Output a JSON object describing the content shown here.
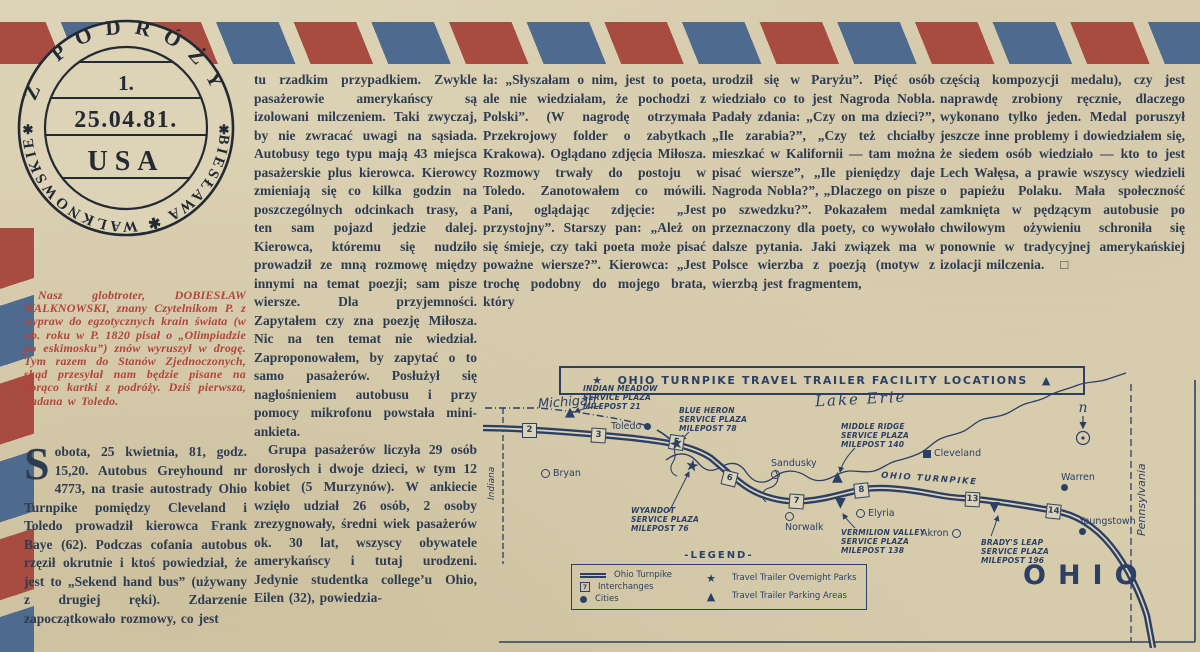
{
  "page": {
    "paper_color": "#dcd2b4",
    "ink_color": "#2e3c52",
    "accent_red": "#b2453b",
    "stripe_red": "#a84b41",
    "stripe_blue": "#4e6a8e",
    "map_ink": "#2c4066"
  },
  "stamp": {
    "arc_top": "Z PODRÓŻY",
    "arc_bottom": "DOBIESŁAWA ✱ WALKNOWSKIEGO",
    "separator": "✱",
    "number": "1.",
    "date": "25.04.81.",
    "country": "USA"
  },
  "article": {
    "intro": "Nasz globtroter, DOBIESŁAW WALKNOWSKI, znany Czytelnikom P. z wypraw do egzotycznych krain świata (w ub. roku w P. 1820 pisał o „Olimpiadzie po eskimosku”) znów wyruszył w drogę. Tym razem do Stanów Zjednoczonych, skąd przesyłał nam będzie pisane na gorąco kartki z podróży. Dziś pierwsza, nadana w Toledo.",
    "col1_dropcap": "S",
    "col1_body": "obota, 25 kwietnia, 81, godz. 15,20. Autobus Greyhound nr 4773, na trasie autostrady Ohio Turnpike pomiędzy Cleveland i Toledo prowadził kierowca Frank Baye (62). Podczas cofania autobus rzęził okrutnie i ktoś powiedział, że jest to „Sekend hand bus” (używany z drugiej ręki). Zdarzenie zapoczątkowało rozmowy, co jest",
    "col2_p1": "tu rzadkim przypadkiem. Zwykle pasażerowie amerykańscy są izolowani milczeniem. Taki zwyczaj, by nie zwracać uwagi na sąsiada. Autobusy tego typu mają 43 miejsca pasażerskie plus kierowca. Kierowcy zmieniają się co kilka godzin na poszczególnych odcinkach trasy, a ten sam pojazd jedzie dalej. Kierowca, któremu się nudziło prowadził ze mną rozmowę między innymi na temat poezji; sam pisze wiersze. Dla przyjemności. Zapytałem czy zna poezję Miłosza. Nic na ten temat nie wiedział. Zaproponowałem, by zapytać o to samo pasażerów. Posłużył się nagłośnieniem autobusu i przy pomocy mikrofonu powstała mini-ankieta.",
    "col2_p2": "Grupa pasażerów liczyła 29 osób dorosłych i dwoje dzieci, w tym 12 kobiet (5 Murzynów). W ankiecie wzięło udział 26 osób, 2 osoby zrezygnowały, średni wiek pasażerów ok. 30 lat, wszyscy obywatele amerykańscy i tutaj urodzeni. Jedynie studentka college’u Ohio, Eilen (32), powiedzia-",
    "col3": "ła: „Słyszałam o nim, jest to poeta, ale nie wiedziałam, że pochodzi z Polski”. (W nagrodę otrzymała Przekrojowy folder o zabytkach Krakowa). Oglądano zdjęcia Miłosza. Rozmowy trwały do postoju w Toledo. Zanotowałem co mówili. Pani, oglądając zdjęcie: „Jest przystojny”. Starszy pan: „Ależ on się śmieje, czy taki poeta może pisać poważne wiersze?”. Kierowca: „Jest trochę podobny do mojego brata, który",
    "col4": "urodził się w Paryżu”. Pięć osób wiedziało co to jest Nagroda Nobla. Padały zdania: „Czy on ma dzieci?”, „Ile zarabia?”, „Czy też chciałby mieszkać w Kalifornii — tam można pisać wiersze”, „Ile pieniędzy daje Nagroda Nobla?”, „Dlaczego on pisze po szwedzku?”. Pokazałem medal przeznaczony dla poety, co wywołało dalsze pytania. Jaki związek ma w Polsce wierzba z poezją (motyw z wierzbą jest fragmentem,",
    "col5": "częścią kompozycji medalu), czy jest naprawdę zrobiony ręcznie, dlaczego wykonano tylko jeden. Medal poruszył jeszcze inne problemy i dowiedziałem się, że siedem osób wiedziało — kto to jest Lech Wałęsa, a prawie wszyscy wiedzieli o papieżu Polaku. Mała społeczność zamknięta w pędzącym autobusie po chwilowym ożywieniu schroniła się ponownie w tradycyjnej amerykańskiej izolacji milczenia.",
    "end_mark": "□"
  },
  "map": {
    "title": {
      "star": "★",
      "text": "OHIO TURNPIKE TRAVEL TRAILER FACILITY LOCATIONS",
      "triangle": "▲"
    },
    "labels": {
      "michigan": "Michigan",
      "indiana": "Indiana",
      "pennsylvania": "Pennsylvania",
      "lake": "Lake Erie",
      "road": "OHIO TURNPIKE",
      "state": "OHIO",
      "compass": "n"
    },
    "interchanges": [
      {
        "n": "2"
      },
      {
        "n": "3"
      },
      {
        "n": "5"
      },
      {
        "n": "6"
      },
      {
        "n": "7"
      },
      {
        "n": "8"
      },
      {
        "n": "13"
      },
      {
        "n": "14"
      }
    ],
    "cities": [
      {
        "name": "Toledo"
      },
      {
        "name": "Bryan"
      },
      {
        "name": "Sandusky"
      },
      {
        "name": "Norwalk"
      },
      {
        "name": "Elyria"
      },
      {
        "name": "Akron"
      },
      {
        "name": "Cleveland"
      },
      {
        "name": "Warren"
      },
      {
        "name": "Youngstown"
      }
    ],
    "plazas": [
      {
        "marker": "▲",
        "l1": "INDIAN MEADOW",
        "l2": "SERVICE PLAZA",
        "l3": "MILEPOST 21"
      },
      {
        "marker": "★",
        "l1": "BLUE HERON",
        "l2": "SERVICE PLAZA",
        "l3": "MILEPOST 78"
      },
      {
        "marker": "★",
        "l1": "WYANDOT",
        "l2": "SERVICE PLAZA",
        "l3": "MILEPOST 76"
      },
      {
        "marker": "▲",
        "l1": "MIDDLE RIDGE",
        "l2": "SERVICE PLAZA",
        "l3": "MILEPOST 140"
      },
      {
        "marker": "▼",
        "l1": "VERMILION VALLEY",
        "l2": "SERVICE PLAZA",
        "l3": "MILEPOST 138"
      },
      {
        "marker": "▼",
        "l1": "BRADY'S LEAP",
        "l2": "SERVICE PLAZA",
        "l3": "MILEPOST 196"
      }
    ],
    "legend": {
      "title": "-LEGEND-",
      "turnpike": "Ohio Turnpike",
      "interchanges": "Interchanges",
      "cities": "Cities",
      "overnight": "Travel Trailer Overnight Parks",
      "parking": "Travel Trailer Parking Areas",
      "sample_number": "7"
    }
  }
}
